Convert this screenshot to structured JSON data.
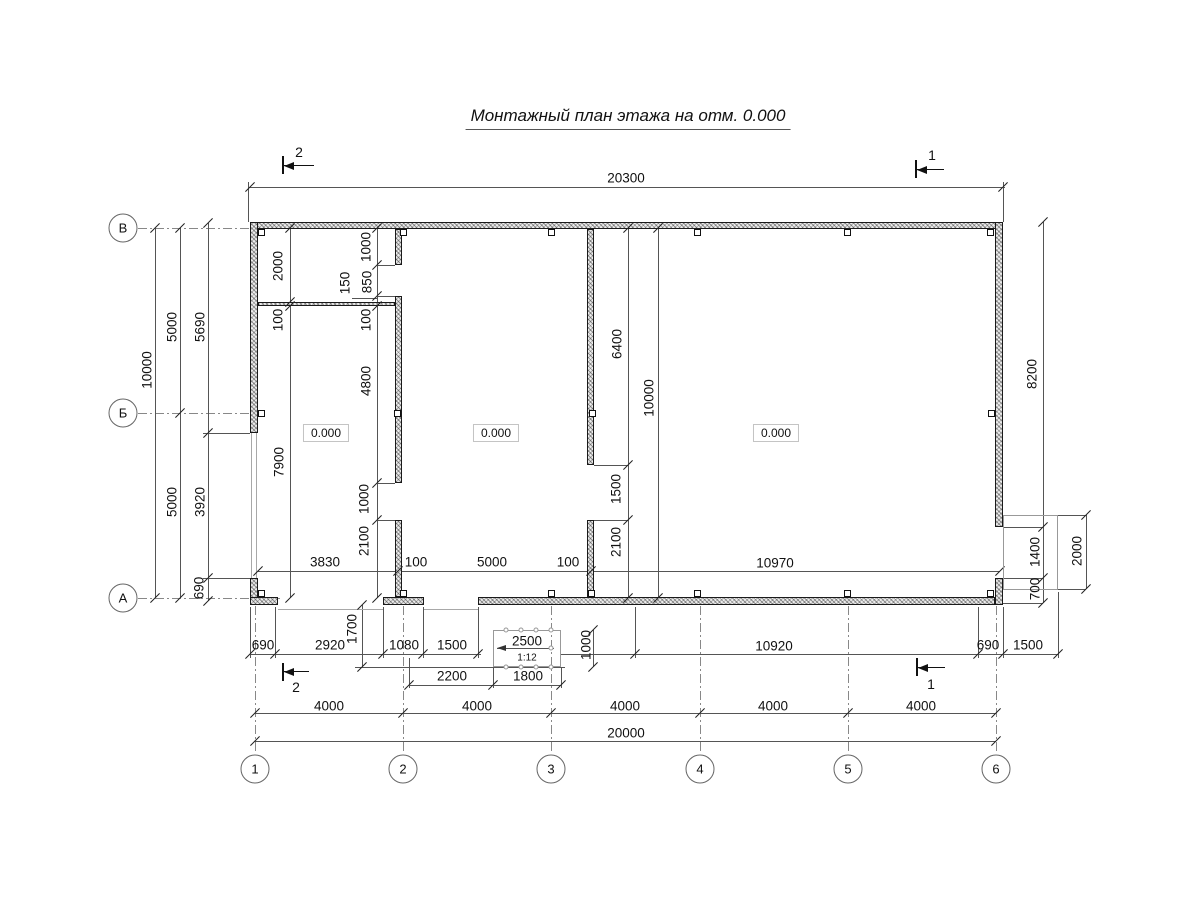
{
  "title": "Монтажный план этажа на отм. 0.000",
  "elevation_value": "0.000",
  "elevation_marks": [
    {
      "x": 326,
      "y": 433
    },
    {
      "x": 496,
      "y": 433
    },
    {
      "x": 776,
      "y": 433
    }
  ],
  "axes": {
    "bottom": [
      {
        "label": "1",
        "x": 255
      },
      {
        "label": "2",
        "x": 403
      },
      {
        "label": "3",
        "x": 551
      },
      {
        "label": "4",
        "x": 700
      },
      {
        "label": "5",
        "x": 848
      },
      {
        "label": "6",
        "x": 996
      }
    ],
    "left": [
      {
        "label": "В",
        "y": 228
      },
      {
        "label": "Б",
        "y": 413
      },
      {
        "label": "А",
        "y": 598
      }
    ]
  },
  "section_marks": [
    {
      "label": "2",
      "x": 299,
      "y": 152
    },
    {
      "label": "1",
      "x": 932,
      "y": 155
    },
    {
      "label": "2",
      "x": 296,
      "y": 687
    },
    {
      "label": "1",
      "x": 931,
      "y": 684
    }
  ],
  "ramp": {
    "length": "2500",
    "slope": "1:12"
  },
  "dim_labels": [
    {
      "t": "20300",
      "x": 626,
      "y": 178
    },
    {
      "t": "3830",
      "x": 325,
      "y": 562
    },
    {
      "t": "100",
      "x": 416,
      "y": 562
    },
    {
      "t": "5000",
      "x": 492,
      "y": 562
    },
    {
      "t": "100",
      "x": 568,
      "y": 562
    },
    {
      "t": "10970",
      "x": 775,
      "y": 563
    },
    {
      "t": "690",
      "x": 263,
      "y": 645
    },
    {
      "t": "2920",
      "x": 330,
      "y": 645
    },
    {
      "t": "1080",
      "x": 404,
      "y": 645
    },
    {
      "t": "1500",
      "x": 452,
      "y": 645
    },
    {
      "t": "2500",
      "x": 527,
      "y": 641
    },
    {
      "t": "1:12",
      "x": 527,
      "y": 658,
      "s": 1
    },
    {
      "t": "10920",
      "x": 774,
      "y": 646
    },
    {
      "t": "690",
      "x": 988,
      "y": 645
    },
    {
      "t": "1500",
      "x": 1028,
      "y": 645
    },
    {
      "t": "2200",
      "x": 452,
      "y": 676
    },
    {
      "t": "1800",
      "x": 528,
      "y": 676
    },
    {
      "t": "4000",
      "x": 329,
      "y": 706
    },
    {
      "t": "4000",
      "x": 477,
      "y": 706
    },
    {
      "t": "4000",
      "x": 625,
      "y": 706
    },
    {
      "t": "4000",
      "x": 773,
      "y": 706
    },
    {
      "t": "4000",
      "x": 921,
      "y": 706
    },
    {
      "t": "20000",
      "x": 626,
      "y": 733
    },
    {
      "t": "10000",
      "x": 147,
      "y": 370,
      "v": 1
    },
    {
      "t": "5000",
      "x": 172,
      "y": 327,
      "v": 1
    },
    {
      "t": "5000",
      "x": 172,
      "y": 502,
      "v": 1
    },
    {
      "t": "5690",
      "x": 200,
      "y": 327,
      "v": 1
    },
    {
      "t": "3920",
      "x": 200,
      "y": 502,
      "v": 1
    },
    {
      "t": "690",
      "x": 199,
      "y": 588,
      "v": 1
    },
    {
      "t": "2000",
      "x": 278,
      "y": 266,
      "v": 1
    },
    {
      "t": "100",
      "x": 278,
      "y": 320,
      "v": 1
    },
    {
      "t": "7900",
      "x": 279,
      "y": 462,
      "v": 1
    },
    {
      "t": "1000",
      "x": 366,
      "y": 247,
      "v": 1
    },
    {
      "t": "850",
      "x": 367,
      "y": 282,
      "v": 1
    },
    {
      "t": "150",
      "x": 345,
      "y": 283,
      "v": 1
    },
    {
      "t": "100",
      "x": 366,
      "y": 320,
      "v": 1
    },
    {
      "t": "4800",
      "x": 366,
      "y": 381,
      "v": 1
    },
    {
      "t": "1000",
      "x": 364,
      "y": 499,
      "v": 1
    },
    {
      "t": "2100",
      "x": 364,
      "y": 541,
      "v": 1
    },
    {
      "t": "1700",
      "x": 352,
      "y": 629,
      "v": 1
    },
    {
      "t": "6400",
      "x": 617,
      "y": 344,
      "v": 1
    },
    {
      "t": "1500",
      "x": 616,
      "y": 489,
      "v": 1
    },
    {
      "t": "2100",
      "x": 616,
      "y": 542,
      "v": 1
    },
    {
      "t": "10000",
      "x": 649,
      "y": 398,
      "v": 1
    },
    {
      "t": "8200",
      "x": 1032,
      "y": 374,
      "v": 1
    },
    {
      "t": "1400",
      "x": 1035,
      "y": 552,
      "v": 1
    },
    {
      "t": "700",
      "x": 1035,
      "y": 589,
      "v": 1
    },
    {
      "t": "2000",
      "x": 1077,
      "y": 551,
      "v": 1
    },
    {
      "t": "1000",
      "x": 586,
      "y": 645,
      "v": 1
    }
  ]
}
